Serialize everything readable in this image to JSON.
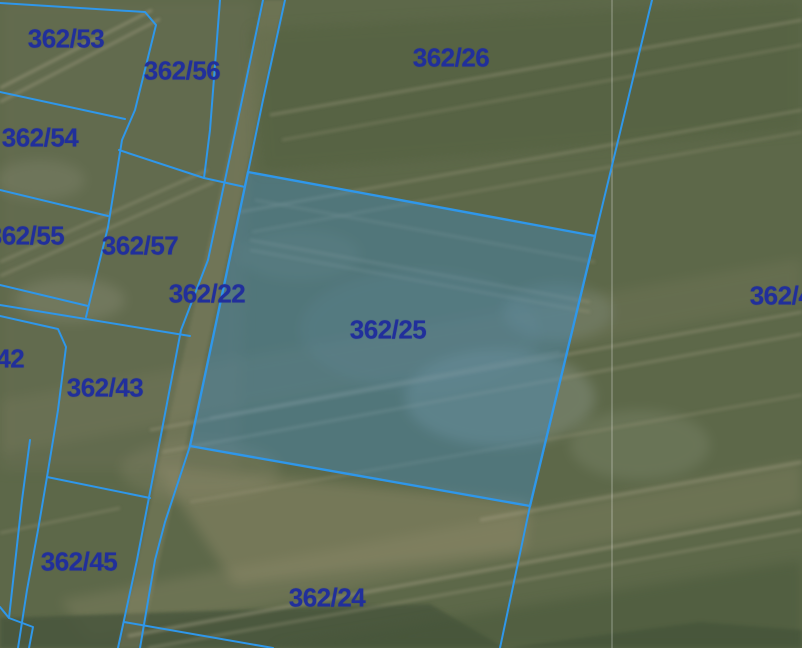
{
  "app": {
    "type": "cadastral-parcel-map"
  },
  "map": {
    "width": 802,
    "height": 648,
    "style": {
      "boundary_color": "#2f97ea",
      "boundary_width": 2,
      "label_color": "#212f9b",
      "selected_fill": "rgba(62,142,202,0.38)",
      "selected_stroke": "#2f97ea",
      "selected_stroke_width": 2.4,
      "seam_color": "rgba(255,255,255,0.32)"
    },
    "seam_x": 612,
    "selected_parcel": {
      "id": "362/25",
      "points": "248,172 595,236 530,506 190,446"
    },
    "boundary_lines": [
      {
        "id": "top-left-corner-line",
        "points": "0,3 145,12 156,25 135,110 122,140 108,227 92,292 86,317"
      },
      {
        "id": "h-53-54",
        "points": "0,92 125,119"
      },
      {
        "id": "h-54-55",
        "points": "0,190 108,216"
      },
      {
        "id": "h-55-bottom",
        "points": "0,285 88,306"
      },
      {
        "id": "h-42-top",
        "points": "0,305 190,336"
      },
      {
        "id": "s-42-43",
        "points": "0,316 58,329 66,347 58,410 47,477 38,530 27,590 18,648"
      },
      {
        "id": "s-45-left",
        "points": "30,440 22,500 9,618 33,627 29,648"
      },
      {
        "id": "s-45-left-tick",
        "points": "0,607 9,618"
      },
      {
        "id": "h-43-45",
        "points": "47,477 150,498"
      },
      {
        "id": "strip-west",
        "points": "263,0 242,100 208,260 181,330 160,440 137,560 118,648"
      },
      {
        "id": "strip-east-upper",
        "points": "285,0 263,100 248,172"
      },
      {
        "id": "strip-east-lower",
        "points": "190,446 165,522 155,560 140,648"
      },
      {
        "id": "v-56-west",
        "points": "220,0 210,130 204,178"
      },
      {
        "id": "d-57-top",
        "points": "119,150 204,178 245,187"
      },
      {
        "id": "east-long-line",
        "points": "652,0 595,236 530,506 500,648"
      },
      {
        "id": "bottom-diagonal",
        "points": "124,622 273,648"
      }
    ],
    "labels": [
      {
        "text": "362/53",
        "x": 66,
        "y": 39
      },
      {
        "text": "362/56",
        "x": 182,
        "y": 71
      },
      {
        "text": "362/26",
        "x": 451,
        "y": 58
      },
      {
        "text": "362/54",
        "x": 40,
        "y": 138
      },
      {
        "text": "362/55",
        "x": 26,
        "y": 236
      },
      {
        "text": "362/57",
        "x": 140,
        "y": 246
      },
      {
        "text": "362/22",
        "x": 207,
        "y": 294
      },
      {
        "text": "362/25",
        "x": 388,
        "y": 330
      },
      {
        "text": "362/42",
        "x": -14,
        "y": 359
      },
      {
        "text": "362/43",
        "x": 105,
        "y": 388
      },
      {
        "text": "362/45",
        "x": 79,
        "y": 562
      },
      {
        "text": "362/24",
        "x": 327,
        "y": 598
      },
      {
        "text": "362/4",
        "x": 781,
        "y": 296
      }
    ]
  }
}
